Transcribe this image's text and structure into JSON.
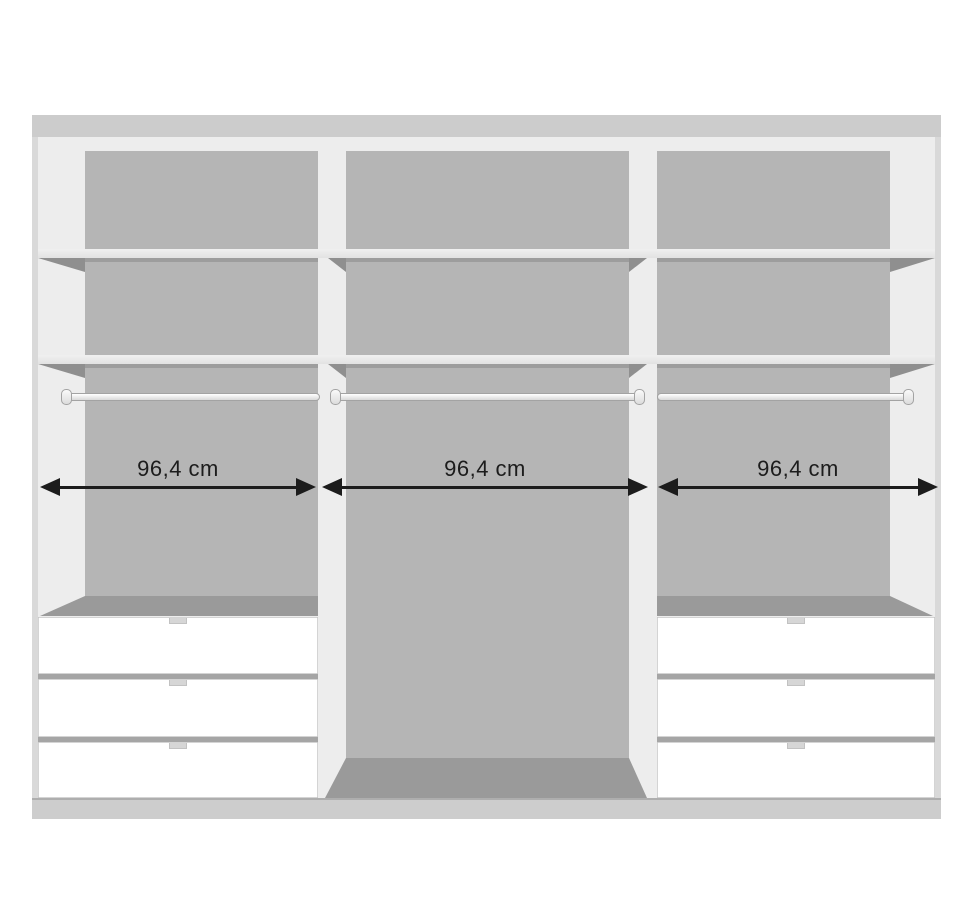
{
  "diagram": {
    "subject": "wardrobe-interior-front-view",
    "unit": "cm"
  },
  "wardrobe": {
    "sections": [
      {
        "id": "left",
        "width_label": "96,4 cm",
        "shelves": 2,
        "hanging_rail": true,
        "drawers": 3
      },
      {
        "id": "middle",
        "width_label": "96,4 cm",
        "shelves": 2,
        "hanging_rail": true,
        "drawers": 0
      },
      {
        "id": "right",
        "width_label": "96,4 cm",
        "shelves": 2,
        "hanging_rail": true,
        "drawers": 3
      }
    ]
  },
  "colors": {
    "ink": "#1c1c1c",
    "panel": "#b5b5b5",
    "wall": "#ededed",
    "shadowline": "#9d9d9d",
    "wedge": "#8f8f8f",
    "floor": "#9a9a9a",
    "frame": "#d9d9d9",
    "topstrip": "#cccccc",
    "plinth": "#cdcdcd",
    "drawer": "#ffffff",
    "drawergap": "#a5a5a5",
    "handle": "#d6d6d6"
  }
}
